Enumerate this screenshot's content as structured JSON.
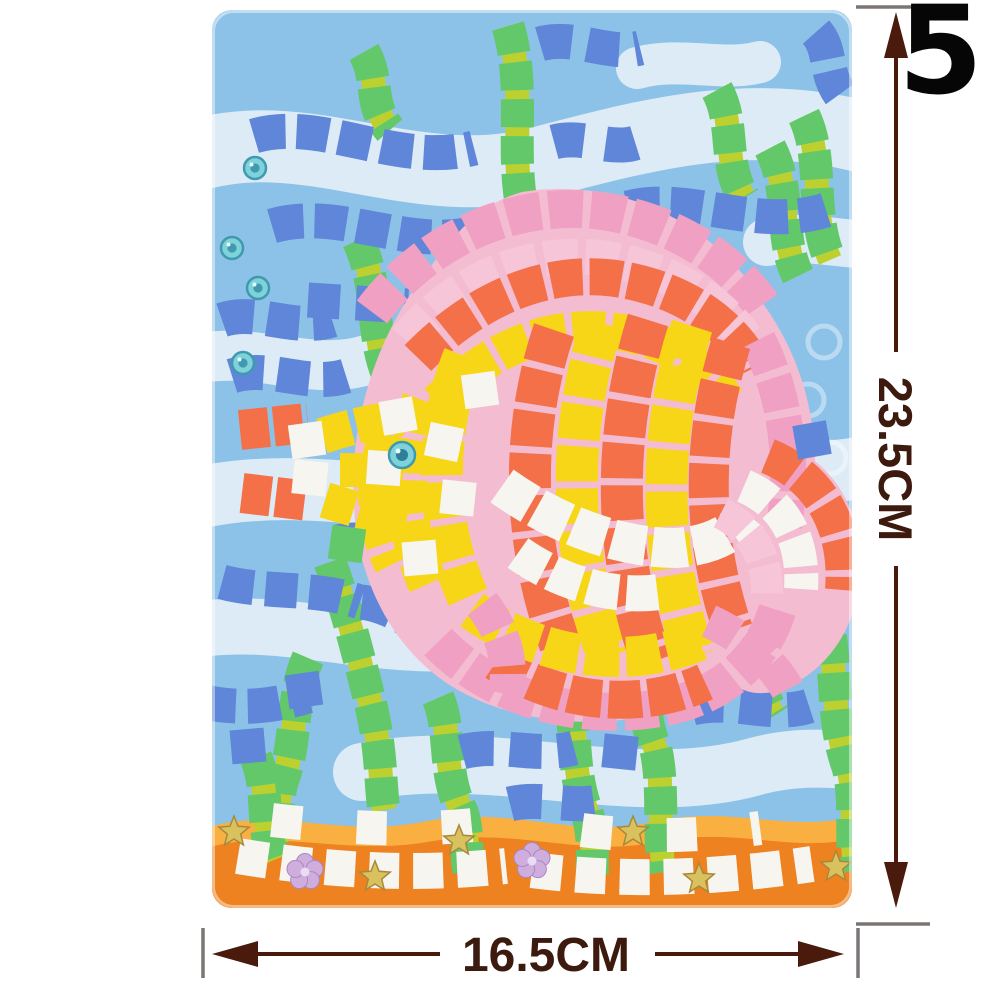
{
  "product_label": {
    "number": "5"
  },
  "dimensions": {
    "height_label": "23.5CM",
    "width_label": "16.5CM",
    "arrow_color": "#4a1b0d",
    "cap_color": "#7b7674",
    "text_color": "#3c1a0e"
  },
  "mosaic": {
    "colors": {
      "card": "#8cc2e8",
      "ribbon": "#e4eff6",
      "blue": "#5f86d8",
      "green": "#62c86a",
      "seagap": "#bcd02f",
      "yellow": "#f6d616",
      "orange": "#f37048",
      "white": "#f6f5ef",
      "pink": "#f0a0c2",
      "lightpink": "#f6c6d8",
      "backing": "#f4bcd1",
      "sand": "#ee8120",
      "sandLight": "#f9b041",
      "gem": "#7fd2da",
      "gemDark": "#3f9ab0",
      "eyeDark": "#2f7f9a",
      "star": "#d9c25e",
      "starEdge": "#a8893a",
      "flower": "#cfaede",
      "flowerEdge": "#a987c4"
    },
    "ribbons": [
      {
        "d": "M -30 150 C 90 105 200 188 330 152 C 445 122 545 95 670 132",
        "w": 72
      },
      {
        "d": "M -30 352 C 40 332 95 368 155 350",
        "w": 50
      },
      {
        "d": "M -30 492 C 110 452 265 522 420 482 C 535 452 615 472 670 452",
        "w": 62
      },
      {
        "d": "M -30 622 C 80 600 175 652 295 626 C 385 606 440 642 478 640",
        "w": 56
      },
      {
        "d": "M 150 762 C 280 735 420 792 545 756 C 605 740 650 756 670 748",
        "w": 58
      },
      {
        "d": "M 555 232 C 598 222 640 240 672 232",
        "w": 48
      },
      {
        "d": "M 425 58 C 468 46 512 62 548 52",
        "w": 42
      }
    ],
    "bubble_prints": [
      [
        612,
        332
      ],
      [
        596,
        390
      ],
      [
        618,
        448
      ],
      [
        602,
        506
      ]
    ],
    "sand": [
      {
        "d": "M -5 818 C 60 796 130 828 210 812 C 300 794 360 830 440 812 C 520 794 575 824 645 806 L 645 900 L -5 900 Z",
        "c": "sandLight"
      },
      {
        "d": "M -5 838 C 60 818 135 846 215 832 C 305 816 365 848 445 832 C 525 816 580 844 645 828 L 645 900 L -5 900 Z",
        "c": "sand"
      }
    ],
    "runs": [
      {
        "d": "M 152 42 C 168 70 156 95 178 120",
        "c": "seagap",
        "w": 24
      },
      {
        "d": "M 152 42 C 168 70 156 95 178 120",
        "c": "green",
        "w": 33,
        "dash": "28 9"
      },
      {
        "d": "M 296 16 C 318 90 290 162 322 238 C 348 302 320 352 345 408",
        "c": "seagap",
        "w": 24
      },
      {
        "d": "M 296 16 C 318 90 290 162 322 238 C 348 302 320 352 345 408",
        "c": "green",
        "w": 33,
        "dash": "28 9"
      },
      {
        "d": "M 505 80 C 524 115 510 152 532 188",
        "c": "seagap",
        "w": 24
      },
      {
        "d": "M 505 80 C 524 115 510 152 532 188",
        "c": "green",
        "w": 33,
        "dash": "28 9"
      },
      {
        "d": "M 592 106 C 613 150 597 202 618 250",
        "c": "seagap",
        "w": 24
      },
      {
        "d": "M 592 106 C 613 150 597 202 618 250",
        "c": "green",
        "w": 33,
        "dash": "28 9"
      },
      {
        "d": "M 558 138 C 580 180 566 225 586 266",
        "c": "seagap",
        "w": 24
      },
      {
        "d": "M 558 138 C 580 180 566 225 586 266",
        "c": "green",
        "w": 33,
        "dash": "28 9"
      },
      {
        "d": "M 146 230 C 170 280 156 332 182 378 C 194 404 188 422 196 440",
        "c": "seagap",
        "w": 24
      },
      {
        "d": "M 146 230 C 170 280 156 332 182 378 C 194 404 188 422 196 440",
        "c": "green",
        "w": 33,
        "dash": "28 9"
      },
      {
        "d": "M 96 648 C 78 690 86 730 70 772 C 64 795 68 812 64 830",
        "c": "seagap",
        "w": 24
      },
      {
        "d": "M 96 648 C 78 690 86 730 70 772 C 64 795 68 812 64 830",
        "c": "green",
        "w": 33,
        "dash": "28 9"
      },
      {
        "d": "M 118 552 C 135 600 148 650 160 700 C 170 745 168 775 172 800",
        "c": "seagap",
        "w": 24
      },
      {
        "d": "M 118 552 C 135 600 148 650 160 700 C 170 745 168 775 172 800",
        "c": "green",
        "w": 33,
        "dash": "28 9"
      },
      {
        "d": "M 226 688 C 240 720 230 762 250 802 C 258 826 252 846 258 864",
        "c": "seagap",
        "w": 24
      },
      {
        "d": "M 226 688 C 240 720 230 762 250 802 C 258 826 252 846 258 864",
        "c": "green",
        "w": 33,
        "dash": "28 9"
      },
      {
        "d": "M 350 658 C 368 700 356 752 375 802 C 385 836 377 856 382 870",
        "c": "seagap",
        "w": 24
      },
      {
        "d": "M 350 658 C 368 700 356 752 375 802 C 385 836 377 856 382 870",
        "c": "green",
        "w": 33,
        "dash": "28 9"
      },
      {
        "d": "M 418 595 C 436 640 424 692 444 740 C 452 776 446 822 452 862",
        "c": "seagap",
        "w": 24
      },
      {
        "d": "M 418 595 C 436 640 424 692 444 740 C 452 776 446 822 452 862",
        "c": "green",
        "w": 33,
        "dash": "28 9"
      },
      {
        "d": "M 610 590 C 628 640 616 702 636 757 C 645 792 637 827 644 860",
        "c": "seagap",
        "w": 24
      },
      {
        "d": "M 610 590 C 628 640 616 702 636 757 C 645 792 637 827 644 860",
        "c": "green",
        "w": 33,
        "dash": "28 9"
      },
      {
        "d": "M 530 598 C 552 634 540 672 562 706",
        "c": "seagap",
        "w": 24
      },
      {
        "d": "M 530 598 C 552 634 540 672 562 706",
        "c": "green",
        "w": 33,
        "dash": "28 9"
      },
      {
        "d": "M 44 748 C 58 780 48 815 62 850",
        "c": "seagap",
        "w": 24
      },
      {
        "d": "M 44 748 C 58 780 48 815 62 850",
        "c": "green",
        "w": 33,
        "dash": "28 9"
      },
      {
        "d": "M 42 126 C 110 106 185 158 262 138",
        "c": "blue",
        "w": 35,
        "dash": "32 11"
      },
      {
        "d": "M 60 216 C 128 196 196 242 268 222",
        "c": "blue",
        "w": 35,
        "dash": "32 11"
      },
      {
        "d": "M 96 290 L 196 296",
        "c": "blue",
        "w": 35,
        "dash": "32 16"
      },
      {
        "d": "M 328 34 C 362 24 396 46 428 38",
        "c": "blue",
        "w": 35,
        "dash": "32 16"
      },
      {
        "d": "M 416 198 C 478 182 545 222 614 200",
        "c": "blue",
        "w": 35,
        "dash": "32 11"
      },
      {
        "d": "M 342 132 C 372 124 400 142 426 132",
        "c": "blue",
        "w": 35,
        "dash": "30 22"
      },
      {
        "d": "M 10 310 C 45 298 82 322 120 310",
        "c": "blue",
        "w": 35,
        "dash": "32 14"
      },
      {
        "d": "M 20 366 C 58 354 96 378 134 366",
        "c": "blue",
        "w": 35,
        "dash": "32 14"
      },
      {
        "d": "M 126 532 C 162 524 200 542 238 532",
        "c": "blue",
        "w": 35,
        "dash": "32 14"
      },
      {
        "d": "M 150 592 C 180 596 208 616 236 640",
        "c": "blue",
        "w": 35,
        "dash": "32 12"
      },
      {
        "d": "M 10 572 C 55 584 102 576 148 592",
        "c": "blue",
        "w": 35,
        "dash": "32 12"
      },
      {
        "d": "M -8 692 C 30 700 62 696 96 686",
        "c": "blue",
        "w": 35,
        "dash": "32 12"
      },
      {
        "d": "M 250 742 C 288 732 324 748 362 738",
        "c": "blue",
        "w": 35,
        "dash": "32 16"
      },
      {
        "d": "M 480 698 C 522 688 560 708 597 696",
        "c": "blue",
        "w": 35,
        "dash": "32 16"
      },
      {
        "d": "M 298 794 C 330 786 364 800 394 790",
        "c": "blue",
        "w": 35,
        "dash": "32 20"
      },
      {
        "d": "M 604 22 C 620 40 612 62 628 84",
        "c": "blue",
        "w": 35,
        "dash": "30 12"
      },
      {
        "d": "M 310 182 C 405 166 505 212 552 295 C 600 362 612 442 598 522 C 585 602 540 662 470 694 C 400 724 298 716 233 672 C 178 634 146 568 142 498 C 136 418 162 328 216 260 C 246 220 268 194 310 182 Z",
        "c": "backing",
        "fill": 1
      },
      {
        "d": "M 545 425 C 612 437 650 492 649 556 C 647 616 616 662 568 680 C 544 688 523 680 514 666 C 540 620 552 545 544 468 Z",
        "c": "backing",
        "fill": 1
      },
      {
        "d": "M 250 588 C 286 612 302 652 296 700 C 278 664 260 624 242 600 Z",
        "c": "backing",
        "fill": 1
      },
      {
        "d": "M 160 302 C 214 230 298 192 382 200 C 456 208 520 248 553 300",
        "c": "pink",
        "w": 38,
        "dash": "34 8"
      },
      {
        "d": "M 194 330 C 244 270 315 240 388 248 C 449 255 506 288 533 328",
        "c": "lightpink",
        "w": 36,
        "dash": "33 8"
      },
      {
        "d": "M 206 348 C 262 290 332 260 400 268 C 468 277 519 312 542 358",
        "c": "orange",
        "w": 37,
        "dash": "32 7"
      },
      {
        "d": "M 226 392 C 272 342 330 316 390 320 C 446 324 492 352 514 390",
        "c": "yellow",
        "w": 37,
        "dash": "32 7"
      },
      {
        "d": "M 546 330 C 574 386 582 452 572 516",
        "c": "pink",
        "w": 36,
        "dash": "33 8"
      },
      {
        "d": "M 176 424 C 160 470 162 516 181 554",
        "c": "yellow",
        "w": 38,
        "dash": "32 8"
      },
      {
        "d": "M 210 390 C 188 450 190 516 216 574",
        "c": "yellow",
        "w": 40,
        "dash": "34 7"
      },
      {
        "d": "M 252 346 C 222 420 222 512 256 587",
        "c": "yellow",
        "w": 42,
        "dash": "36 7"
      },
      {
        "d": "M 342 320 C 308 420 310 532 348 634",
        "c": "orange",
        "w": 42,
        "dash": "35 7"
      },
      {
        "d": "M 390 313 C 354 425 357 542 396 647",
        "c": "yellow",
        "w": 42,
        "dash": "35 7"
      },
      {
        "d": "M 436 310 C 399 428 402 545 440 652",
        "c": "orange",
        "w": 42,
        "dash": "35 7"
      },
      {
        "d": "M 480 316 C 444 430 447 547 483 647",
        "c": "yellow",
        "w": 42,
        "dash": "35 7"
      },
      {
        "d": "M 519 333 C 488 432 490 530 521 620",
        "c": "orange",
        "w": 40,
        "dash": "34 7"
      },
      {
        "d": "M 226 632 C 282 690 372 714 458 696 C 518 682 552 644 566 598",
        "c": "pink",
        "w": 38,
        "dash": "33 8"
      },
      {
        "d": "M 284 652 C 350 696 432 700 493 672",
        "c": "orange",
        "w": 38,
        "dash": "33 7"
      },
      {
        "d": "M 260 600 C 330 650 420 660 489 630",
        "c": "yellow",
        "w": 40,
        "dash": "34 7"
      },
      {
        "d": "M 290 476 C 345 515 408 538 464 538 C 497 536 521 524 536 505",
        "c": "white",
        "w": 40,
        "dash": "34 7"
      },
      {
        "d": "M 306 543 C 350 574 402 588 447 582",
        "c": "white",
        "w": 36,
        "dash": "31 8"
      },
      {
        "d": "M 270 594 C 292 622 300 654 294 684",
        "c": "pink",
        "w": 36,
        "dash": "30 8"
      },
      {
        "d": "M 556 446 C 610 468 636 520 631 580",
        "c": "orange",
        "w": 36,
        "dash": "31 7"
      },
      {
        "d": "M 532 476 C 574 494 592 532 589 579",
        "c": "white",
        "w": 34,
        "dash": "30 7"
      },
      {
        "d": "M 509 503 C 541 519 556 549 555 586",
        "c": "lightpink",
        "w": 32,
        "dash": "28 7"
      },
      {
        "d": "M 497 611 C 536 629 564 655 579 686",
        "c": "pink",
        "w": 34,
        "dash": "30 8"
      },
      {
        "d": "M 110 426 C 140 416 165 411 190 408",
        "c": "yellow",
        "w": 36,
        "dash": "30 6"
      },
      {
        "d": "M 113 490 C 142 499 168 507 194 512",
        "c": "yellow",
        "w": 36,
        "dash": "30 6"
      },
      {
        "d": "M 128 460 C 152 460 172 461 192 462",
        "c": "yellow",
        "w": 34,
        "dash": "28 7"
      },
      {
        "d": "M 28 420 L 96 413",
        "c": "orange",
        "w": 40,
        "dash": "29 5"
      },
      {
        "d": "M 30 483 L 97 491",
        "c": "orange",
        "w": 40,
        "dash": "29 5"
      },
      {
        "d": "M 26 846 C 110 860 202 866 294 856",
        "c": "white",
        "w": 36,
        "dash": "30 14"
      },
      {
        "d": "M 320 860 C 410 872 506 868 600 854",
        "c": "white",
        "w": 36,
        "dash": "30 14"
      },
      {
        "d": "M 60 810 C 130 818 202 822 270 814",
        "c": "white",
        "w": 34,
        "dash": "30 55"
      },
      {
        "d": "M 370 820 C 430 828 492 826 548 818",
        "c": "white",
        "w": 34,
        "dash": "30 55"
      }
    ],
    "tiles": [
      [
        268,
        380,
        -8,
        "white"
      ],
      [
        246,
        488,
        6,
        "white"
      ],
      [
        208,
        548,
        -5,
        "white"
      ],
      [
        172,
        458,
        4,
        "white"
      ],
      [
        186,
        406,
        -10,
        "white"
      ],
      [
        232,
        432,
        12,
        "white"
      ],
      [
        95,
        430,
        -8,
        "white"
      ],
      [
        98,
        468,
        6,
        "white"
      ],
      [
        600,
        430,
        -10,
        "blue"
      ],
      [
        408,
        742,
        6,
        "blue"
      ],
      [
        92,
        680,
        -8,
        "blue"
      ],
      [
        36,
        736,
        -5,
        "blue"
      ],
      [
        135,
        534,
        8,
        "green"
      ]
    ],
    "gems": [
      [
        43,
        158
      ],
      [
        20,
        238
      ],
      [
        46,
        278
      ],
      [
        31,
        353
      ]
    ],
    "eye": {
      "x": 190,
      "y": 445
    },
    "stars": [
      [
        22,
        822
      ],
      [
        247,
        831
      ],
      [
        163,
        867
      ],
      [
        421,
        822
      ],
      [
        487,
        869
      ],
      [
        624,
        857
      ]
    ],
    "flowers": [
      [
        93,
        862
      ],
      [
        320,
        851
      ]
    ]
  }
}
